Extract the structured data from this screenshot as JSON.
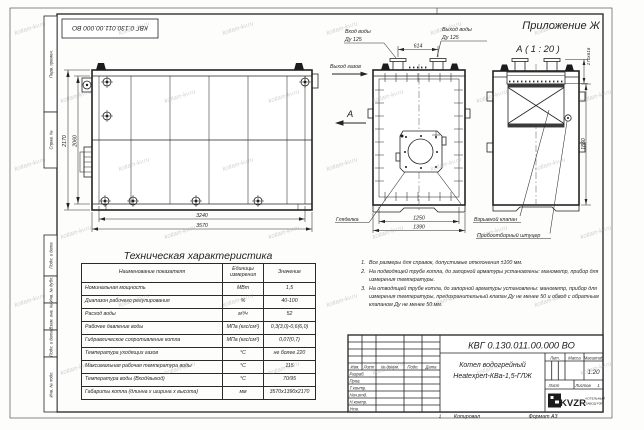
{
  "watermark": {
    "text": "kotlam-kv.ru"
  },
  "frame": {
    "doc_number_top": "КВГ 0.130.011.00.000 ВО",
    "margin_labels": [
      "Перв. примен.",
      "Справ. №",
      "Подп. и дата",
      "Инв. № дубл.",
      "Взам. инв. №",
      "Подп. и дата",
      "Инв. № подл."
    ],
    "zone_number": "1",
    "copied_label": "Копировал",
    "format_label": "Формат А3"
  },
  "annex_title": "Приложение Ж",
  "views": {
    "side": {
      "dim_height_outer": "2170",
      "dim_height_inner": "2060",
      "dim_width_inner": "3240",
      "dim_width_outer": "3570"
    },
    "front": {
      "water_in_line1": "Вход воды",
      "water_in_line2": "Ду 125",
      "water_out_line1": "Выход воды",
      "water_out_line2": "Ду 125",
      "dim_nozzles": "614",
      "gas_out_label": "Выход газов",
      "section_letter": "А",
      "sight_glass_label": "Гляделка",
      "dim_width_inner": "1250",
      "dim_width_outer": "1390"
    },
    "section_a": {
      "title": "А ( 1 : 20 )",
      "dim_duct": "170х616",
      "dim_height": "1860",
      "explosion_valve_label": "Взрывной клапан",
      "sampling_port_label": "Пробоотборный штуцер"
    }
  },
  "tech_table": {
    "title": "Техническая характеристика",
    "col_headers": [
      "Наименование показателя",
      "Единицы измерения",
      "Значение"
    ],
    "rows": [
      [
        "Номинальная мощность",
        "МВт",
        "1,5"
      ],
      [
        "Диапазон рабочего регулирования",
        "%",
        "40-100"
      ],
      [
        "Расход воды",
        "м³/ч",
        "52"
      ],
      [
        "Рабочее давление воды",
        "МПа (кгс/см²)",
        "0,3(3,0)-0,6(6,0)"
      ],
      [
        "Гидравлическое сопротивление котла",
        "МПа (кгс/см²)",
        "0,07(0,7)"
      ],
      [
        "Температура уходящих газов",
        "°С",
        "не более 220"
      ],
      [
        "Максимальная рабочая температура воды",
        "°С",
        "115"
      ],
      [
        "Температура воды (Вход/выход)",
        "°С",
        "70/95"
      ],
      [
        "Габариты котла (длинна х ширина х высота)",
        "мм",
        "3570х1390х2170"
      ]
    ]
  },
  "notes": {
    "items": [
      "Все размеры для справок, допустимые отклонения ±100 мм.",
      "На подводящей трубе котла, до запорной арматуры установлены: манометр, прибор для измерения температуры.",
      "На отводящей трубе котла, до запорной арматуры установлены: манометр, прибор для измерения температуры, предохранительный клапан Ду не менее 50 и обвод с обратным клапаном Ду не менее 50 мм."
    ]
  },
  "title_block": {
    "doc_number": "КВГ 0.130.011.00.000 ВО",
    "product_name_line1": "Котел водогрейный",
    "product_name_line2": "Heatexpert-КВа-1,5-ГЛЖ",
    "rev_cols": [
      "Изм.",
      "Лист",
      "№ докум.",
      "Подп.",
      "Дата"
    ],
    "sign_rows": [
      "Разраб.",
      "Пров.",
      "Т.контр.",
      "Нач.отд.",
      "Н.контр.",
      "Утв."
    ],
    "lit_label": "Лит.",
    "mass_label": "Масса",
    "scale_label": "Масштаб",
    "scale_value": "1:20",
    "sheet_label": "Лист",
    "sheets_label": "Листов",
    "sheets_value": "1",
    "logo_text": "KVZR",
    "company_line1": "КОТЕЛЬНЫЙ",
    "company_line2": "ЗАВОД РЭП"
  }
}
